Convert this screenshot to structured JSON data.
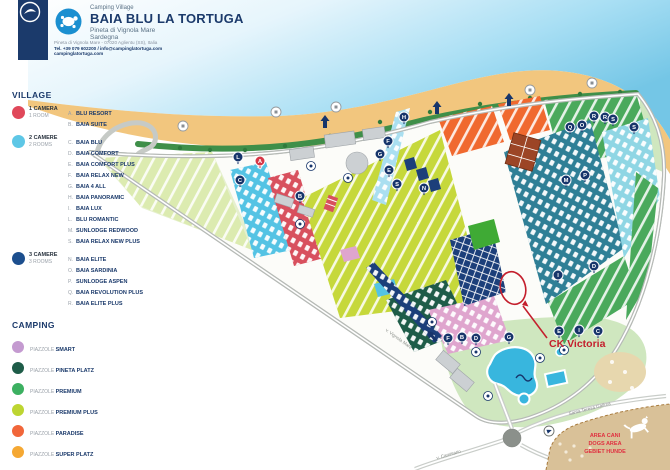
{
  "header": {
    "brand": "Camping Village",
    "title": "BAIA BLU LA TORTUGA",
    "subtitle": "Pineta di Vignola Mare",
    "region": "Sardegna",
    "address": "Pineta di Vignola Mare - 07020 Aglientu (SS), Italia",
    "contacts": "Tel. +39 079 602200 / info@campinglatortuga.com",
    "website": "campinglatortuga.com"
  },
  "legend": {
    "village_title": "VILLAGE",
    "village": [
      {
        "color": "#e0485a",
        "rooms_it": "1 CAMERA",
        "rooms_en": "1 ROOM",
        "items": [
          [
            "A.",
            "BLU RESORT"
          ],
          [
            "B.",
            "BAIA SUITE"
          ]
        ]
      },
      {
        "color": "#5ec7e6",
        "rooms_it": "2 CAMERE",
        "rooms_en": "2 ROOMS",
        "items": [
          [
            "C.",
            "BAIA BLU"
          ],
          [
            "D.",
            "BAIA COMFORT"
          ],
          [
            "E.",
            "BAIA COMFORT PLUS"
          ],
          [
            "F.",
            "BAIA RELAX NEW"
          ],
          [
            "G.",
            "BAIA 4 ALL"
          ],
          [
            "H.",
            "BAIA PANORAMIC"
          ],
          [
            "I.",
            "BAIA LUX"
          ],
          [
            "L.",
            "BLU ROMANTIC"
          ],
          [
            "M.",
            "SUNLODGE REDWOOD"
          ],
          [
            "S.",
            "BAIA RELAX NEW PLUS"
          ]
        ]
      },
      {
        "color": "#1c4f8e",
        "rooms_it": "3 CAMERE",
        "rooms_en": "3 ROOMS",
        "items": [
          [
            "N.",
            "BAIA ELITE"
          ],
          [
            "O.",
            "BAIA SARDINIA"
          ],
          [
            "P.",
            "SUNLODGE ASPEN"
          ],
          [
            "Q.",
            "BAIA REVOLUTION PLUS"
          ],
          [
            "R.",
            "BAIA ELITE PLUS"
          ]
        ]
      }
    ],
    "camping_title": "CAMPING",
    "camping": [
      {
        "color": "#c49ad0",
        "prefix": "PIAZZOLE",
        "name": "SMART"
      },
      {
        "color": "#1e5c48",
        "prefix": "PIAZZOLE",
        "name": "PINETA PLATZ"
      },
      {
        "color": "#3cb061",
        "prefix": "PIAZZOLE",
        "name": "PREMIUM"
      },
      {
        "color": "#bdd531",
        "prefix": "PIAZZOLE",
        "name": "PREMIUM PLUS"
      },
      {
        "color": "#f1663a",
        "prefix": "PIAZZOLE",
        "name": "PARADISE"
      },
      {
        "color": "#f5a833",
        "prefix": "PIAZZOLE",
        "name": "SUPER PLATZ"
      }
    ]
  },
  "map": {
    "annotation": "CK Victoria",
    "annotation_color": "#c41f2d",
    "dog_area_lines": [
      "AREA CANI",
      "DOGS AREA",
      "GEBIET HUNDE"
    ],
    "road_labels": {
      "southeast": "Santa Teresa Gallura",
      "south": "v. Camisario",
      "west": "v. Vignola Mare"
    },
    "marker_color": "#17356b",
    "marker_alt_color": "#d63848",
    "markers": [
      {
        "letter": "L",
        "x": 238,
        "y": 157
      },
      {
        "letter": "A",
        "x": 260,
        "y": 161,
        "color": "#d63848"
      },
      {
        "letter": "C",
        "x": 240,
        "y": 180
      },
      {
        "letter": "B",
        "x": 300,
        "y": 196
      },
      {
        "letter": "H",
        "x": 404,
        "y": 117
      },
      {
        "letter": "F",
        "x": 388,
        "y": 141
      },
      {
        "letter": "G",
        "x": 380,
        "y": 154
      },
      {
        "letter": "E",
        "x": 389,
        "y": 170
      },
      {
        "letter": "S",
        "x": 397,
        "y": 184
      },
      {
        "letter": "N",
        "x": 424,
        "y": 188
      },
      {
        "letter": "Q",
        "x": 570,
        "y": 127
      },
      {
        "letter": "O",
        "x": 582,
        "y": 125
      },
      {
        "letter": "R",
        "x": 594,
        "y": 116
      },
      {
        "letter": "R",
        "x": 605,
        "y": 117
      },
      {
        "letter": "S",
        "x": 613,
        "y": 119
      },
      {
        "letter": "S",
        "x": 634,
        "y": 127
      },
      {
        "letter": "M",
        "x": 566,
        "y": 180
      },
      {
        "letter": "P",
        "x": 585,
        "y": 175
      },
      {
        "letter": "D",
        "x": 594,
        "y": 266
      },
      {
        "letter": "I",
        "x": 558,
        "y": 275
      },
      {
        "letter": "E",
        "x": 559,
        "y": 331
      },
      {
        "letter": "I",
        "x": 579,
        "y": 330
      },
      {
        "letter": "C",
        "x": 598,
        "y": 331
      },
      {
        "letter": "F",
        "x": 448,
        "y": 338
      },
      {
        "letter": "B",
        "x": 462,
        "y": 337
      },
      {
        "letter": "D",
        "x": 476,
        "y": 338
      },
      {
        "letter": "G",
        "x": 509,
        "y": 337
      }
    ]
  }
}
